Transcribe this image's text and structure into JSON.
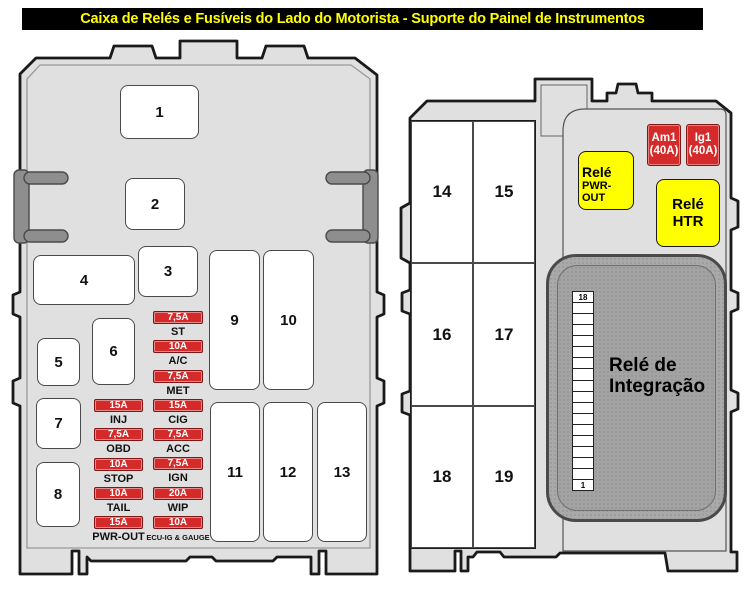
{
  "title": "Caixa de Relés e Fusíveis do Lado do Motorista - Suporte do Painel de Instrumentos",
  "colors": {
    "panel_fill": "#e0e0e0",
    "outline": "#1a1a1a",
    "fuse_red": "#d42a2a",
    "relay_yellow": "#ffff00",
    "title_bg": "#000000",
    "title_fg": "#ffff00",
    "integration_gray": "#a9a9a9",
    "clip_gray": "#8e8e8e"
  },
  "left_panel": {
    "slots": [
      "1",
      "2",
      "3",
      "4",
      "5",
      "6",
      "7",
      "8",
      "9",
      "10",
      "11",
      "12",
      "13"
    ],
    "fuses_left_column": [
      {
        "amp": "15A",
        "label": "INJ"
      },
      {
        "amp": "7,5A",
        "label": "OBD"
      },
      {
        "amp": "10A",
        "label": "STOP"
      },
      {
        "amp": "10A",
        "label": "TAIL"
      },
      {
        "amp": "15A",
        "label": "PWR-OUT"
      }
    ],
    "fuses_right_column": [
      {
        "amp": "7,5A",
        "label": "ST"
      },
      {
        "amp": "10A",
        "label": "A/C"
      },
      {
        "amp": "7,5A",
        "label": "MET"
      },
      {
        "amp": "15A",
        "label": "CIG"
      },
      {
        "amp": "7,5A",
        "label": "ACC"
      },
      {
        "amp": "7,5A",
        "label": "IGN"
      },
      {
        "amp": "20A",
        "label": "WIP"
      },
      {
        "amp": "10A",
        "label": "ECU-IG & GAUGE"
      }
    ]
  },
  "right_panel": {
    "slots": [
      "14",
      "15",
      "16",
      "17",
      "18",
      "19"
    ],
    "fuses": [
      {
        "name": "Am1",
        "rating": "(40A)"
      },
      {
        "name": "Ig1",
        "rating": "(40A)"
      }
    ],
    "relays": [
      {
        "name": "Relé",
        "label": "PWR-OUT"
      },
      {
        "name": "Relé",
        "label": "HTR"
      }
    ],
    "integration_relay": {
      "name_line1": "Relé de",
      "name_line2": "Integração",
      "pin_top": "18",
      "pin_bottom": "1"
    }
  }
}
